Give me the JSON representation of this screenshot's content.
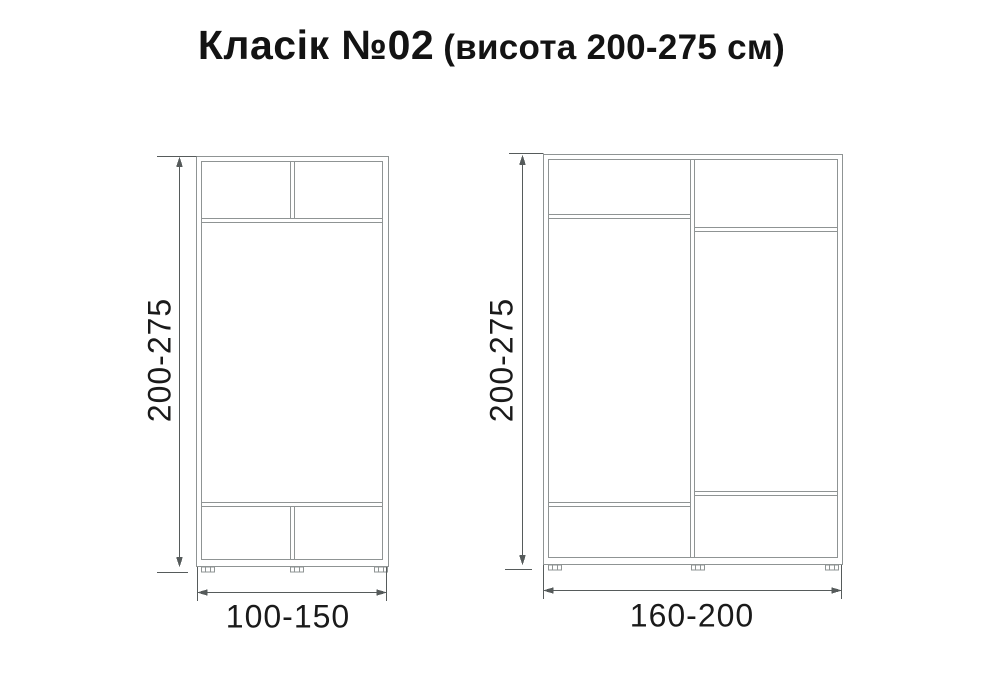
{
  "title": {
    "main": "Класік №02",
    "sub": "(висота 200-275 см)"
  },
  "wardrobes": {
    "small": {
      "height_label": "200-275",
      "width_label": "100-150"
    },
    "large": {
      "height_label": "200-275",
      "width_label": "160-200"
    }
  },
  "colors": {
    "furniture_line": "#8f9494",
    "dimension_line": "#565b5b",
    "text": "#1a1a1a",
    "background": "#ffffff"
  }
}
